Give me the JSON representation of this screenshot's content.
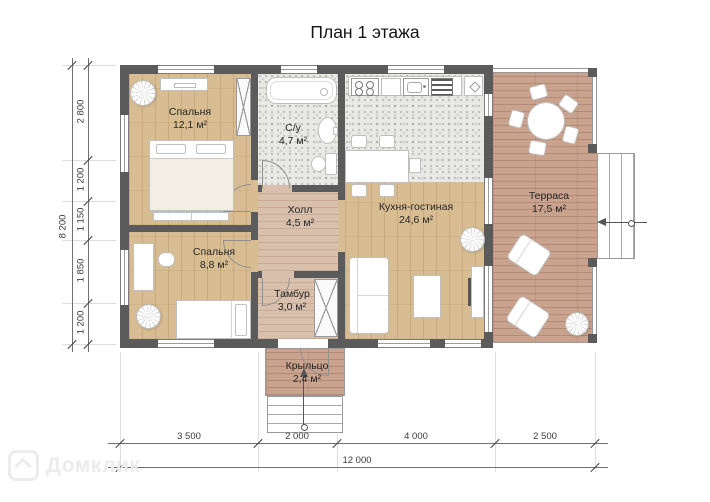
{
  "title": "План 1 этажа",
  "rooms": {
    "bedroom1": {
      "name": "Спальня",
      "area": "12,1 м²"
    },
    "bathroom": {
      "name": "С/у",
      "area": "4,7 м²"
    },
    "kitchen_living": {
      "name": "Кухня-гостиная",
      "area": "24,6 м²"
    },
    "terrace": {
      "name": "Терраса",
      "area": "17,5 м²"
    },
    "hall": {
      "name": "Холл",
      "area": "4,5 м²"
    },
    "bedroom2": {
      "name": "Спальня",
      "area": "8,8 м²"
    },
    "vestibule": {
      "name": "Тамбур",
      "area": "3,0 м²"
    },
    "porch": {
      "name": "Крыльцо",
      "area": "2,4 м²"
    }
  },
  "dimensions": {
    "vertical": {
      "total": "8 200",
      "segments": [
        "2 800",
        "1 200",
        "1 150",
        "1 850",
        "1 200"
      ]
    },
    "horizontal": {
      "total": "12 000",
      "segments": [
        "3 500",
        "2 000",
        "4 000",
        "2 500"
      ]
    }
  },
  "watermark": "Домклик",
  "colors": {
    "wall": "#5b5b5b",
    "wood_floor": "#d8bd92",
    "hall_floor": "#d8c0ad",
    "deck_floor": "#c9a38e",
    "tile_floor": "#e9e9e5"
  }
}
